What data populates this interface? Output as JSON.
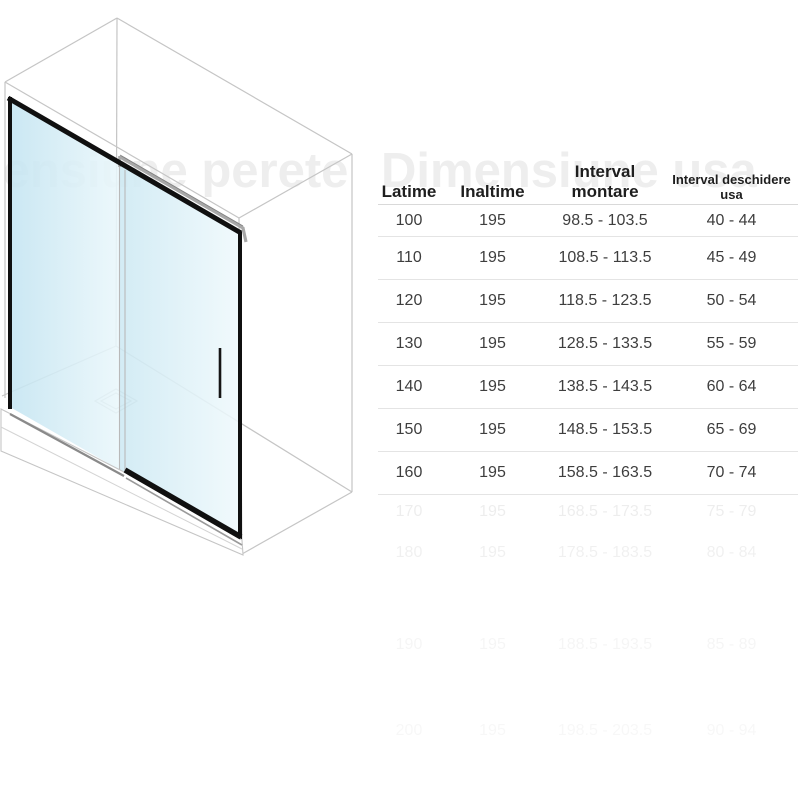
{
  "watermarks": {
    "left_text": "Dimensiune perete",
    "right_text": "Dimensiune usa"
  },
  "illustration": {
    "name": "sliding-glass-shower-door-isometric"
  },
  "table": {
    "headers": [
      "Latime",
      "Inaltime",
      "Interval montare",
      "Interval deschidere usa"
    ],
    "rows": [
      [
        "100",
        "195",
        "98.5 - 103.5",
        "40 - 44"
      ],
      [
        "110",
        "195",
        "108.5 - 113.5",
        "45 - 49"
      ],
      [
        "120",
        "195",
        "118.5 - 123.5",
        "50 - 54"
      ],
      [
        "130",
        "195",
        "128.5 - 133.5",
        "55 - 59"
      ],
      [
        "140",
        "195",
        "138.5 - 143.5",
        "60 - 64"
      ],
      [
        "150",
        "195",
        "148.5 - 153.5",
        "65 - 69"
      ],
      [
        "160",
        "195",
        "158.5 - 163.5",
        "70 - 74"
      ]
    ],
    "faded_rows": [
      [
        "170",
        "195",
        "168.5 - 173.5",
        "75 - 79"
      ],
      [
        "180",
        "195",
        "178.5 - 183.5",
        "80 - 84"
      ],
      [
        "190",
        "195",
        "188.5 - 193.5",
        "85 - 89"
      ],
      [
        "200",
        "195",
        "198.5 - 203.5",
        "90 - 94"
      ]
    ]
  },
  "colors": {
    "glass_dark": "#c6e5f1",
    "glass_light": "#ecf8fb",
    "frame_black": "#101010",
    "outline_gray": "#c5c5c5",
    "silver": "#a8a8a8",
    "separator": "#e4e4e4",
    "text_dark": "#3e3e3e",
    "watermark_gray": "#eeeeee"
  }
}
